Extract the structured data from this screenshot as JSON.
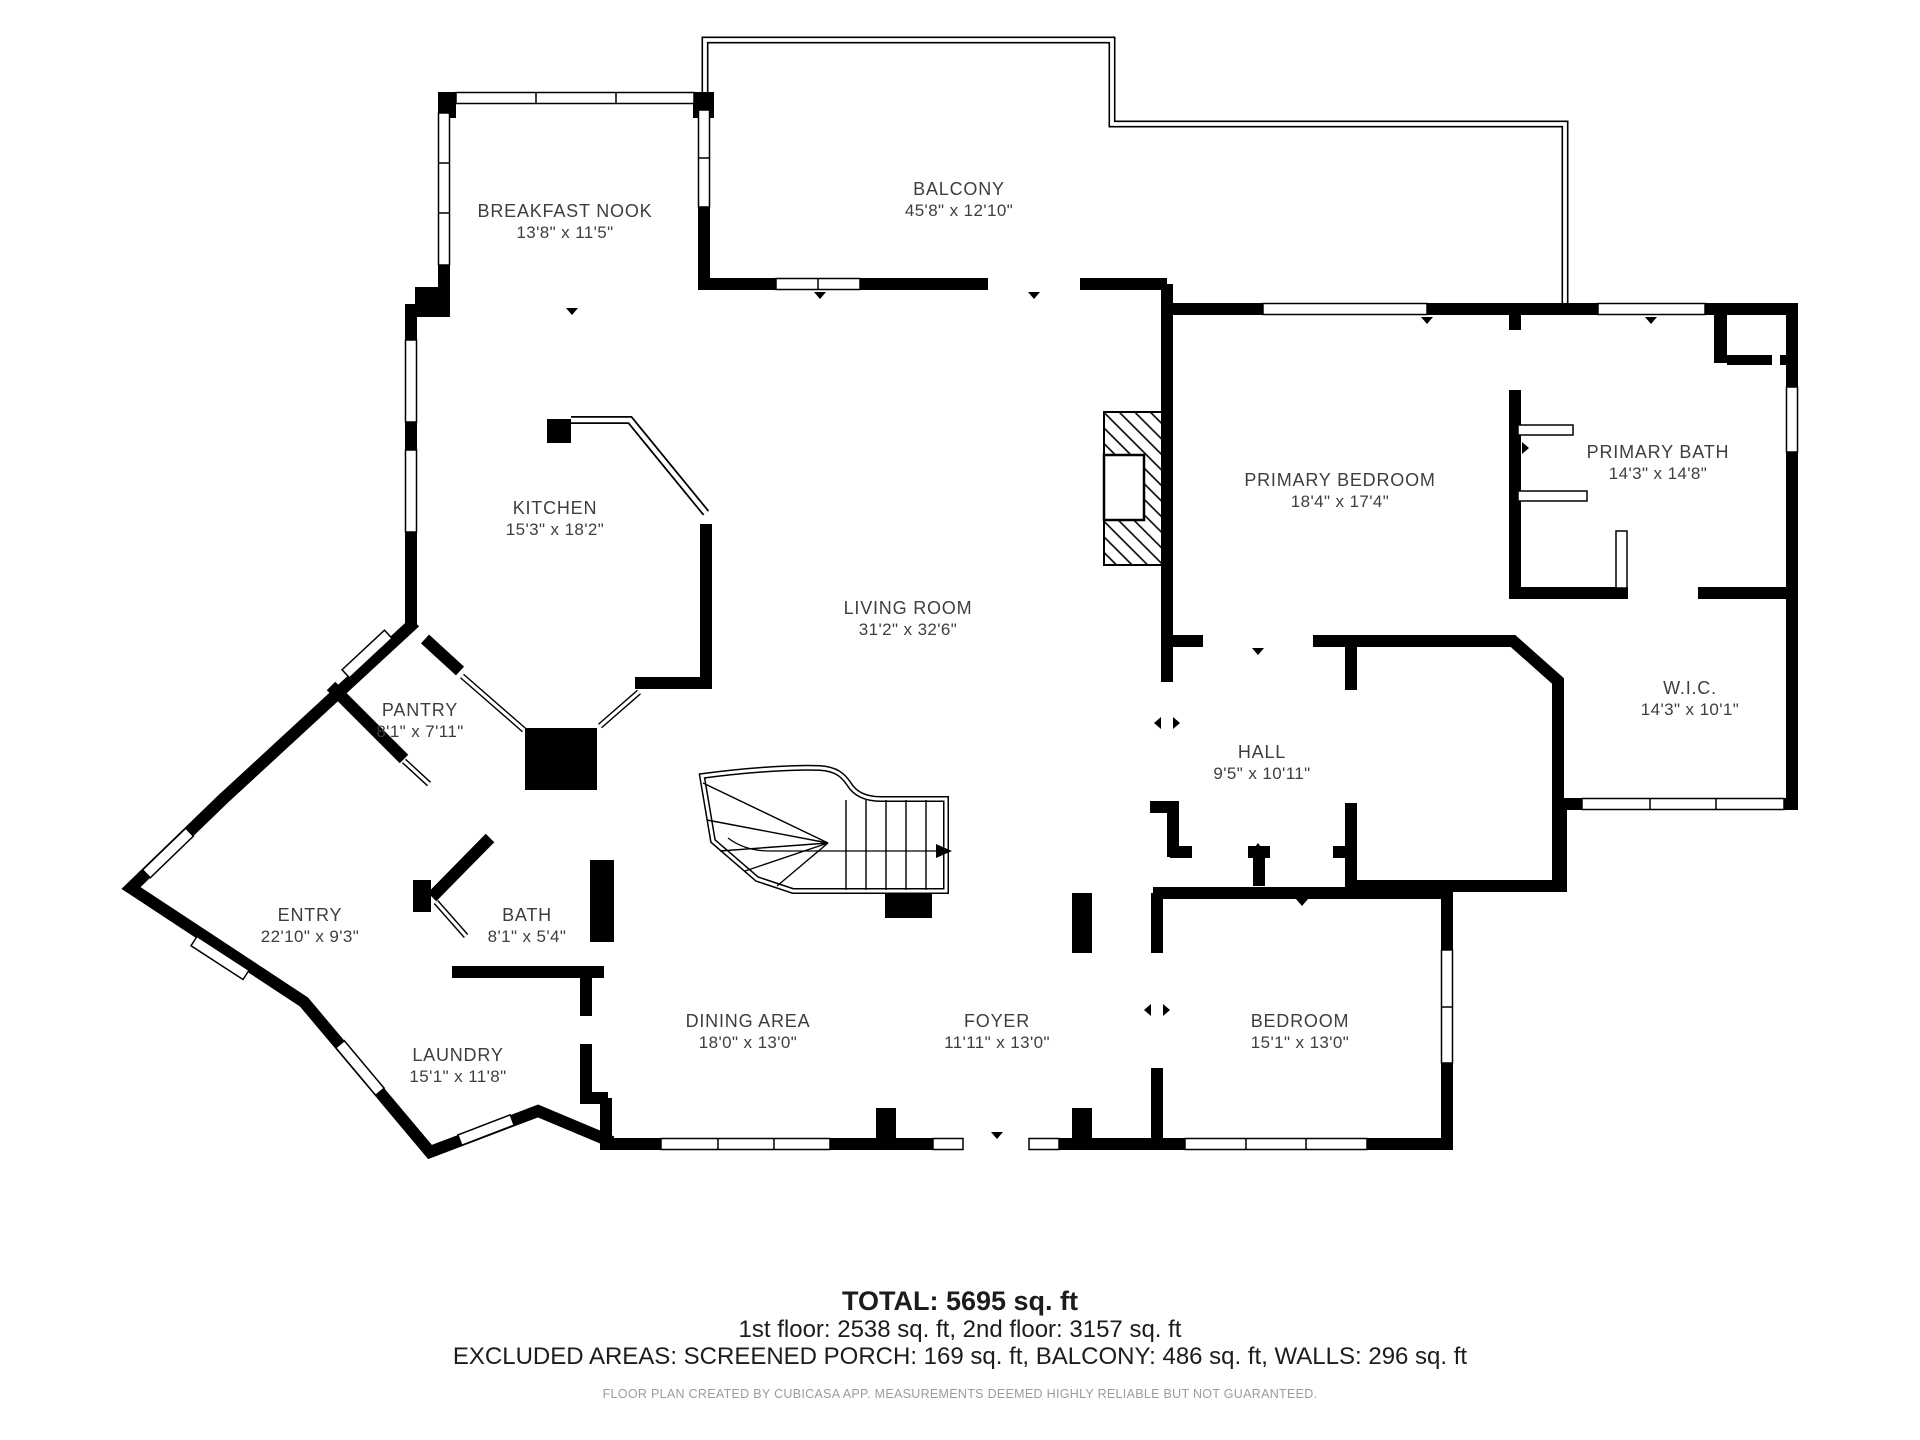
{
  "rooms": [
    {
      "id": "breakfast-nook",
      "name": "BREAKFAST NOOK",
      "dims": "13'8\" x 11'5\""
    },
    {
      "id": "balcony",
      "name": "BALCONY",
      "dims": "45'8\" x 12'10\""
    },
    {
      "id": "kitchen",
      "name": "KITCHEN",
      "dims": "15'3\" x 18'2\""
    },
    {
      "id": "primary-bedroom",
      "name": "PRIMARY BEDROOM",
      "dims": "18'4\" x 17'4\""
    },
    {
      "id": "primary-bath",
      "name": "PRIMARY BATH",
      "dims": "14'3\" x 14'8\""
    },
    {
      "id": "wic",
      "name": "W.I.C.",
      "dims": "14'3\" x 10'1\""
    },
    {
      "id": "living-room",
      "name": "LIVING ROOM",
      "dims": "31'2\" x 32'6\""
    },
    {
      "id": "hall",
      "name": "HALL",
      "dims": "9'5\" x 10'11\""
    },
    {
      "id": "pantry",
      "name": "PANTRY",
      "dims": "8'1\" x 7'11\""
    },
    {
      "id": "entry",
      "name": "ENTRY",
      "dims": "22'10\" x 9'3\""
    },
    {
      "id": "bath",
      "name": "BATH",
      "dims": "8'1\" x 5'4\""
    },
    {
      "id": "laundry",
      "name": "LAUNDRY",
      "dims": "15'1\" x 11'8\""
    },
    {
      "id": "dining-area",
      "name": "DINING AREA",
      "dims": "18'0\" x 13'0\""
    },
    {
      "id": "foyer",
      "name": "FOYER",
      "dims": "11'11\" x 13'0\""
    },
    {
      "id": "bedroom",
      "name": "BEDROOM",
      "dims": "15'1\" x 13'0\""
    }
  ],
  "summary": {
    "total": "TOTAL: 5695 sq. ft",
    "floors": "1st floor: 2538 sq. ft, 2nd floor: 3157 sq. ft",
    "excluded": "EXCLUDED AREAS: SCREENED PORCH: 169 sq. ft, BALCONY: 486 sq. ft, WALLS: 296 sq. ft",
    "disclaimer": "FLOOR PLAN CREATED BY CUBICASA APP. MEASUREMENTS DEEMED HIGHLY RELIABLE BUT NOT GUARANTEED."
  },
  "colors": {
    "wall": "#000000",
    "label": "#3e3e3e",
    "disclaimer": "#9b9b9b"
  }
}
